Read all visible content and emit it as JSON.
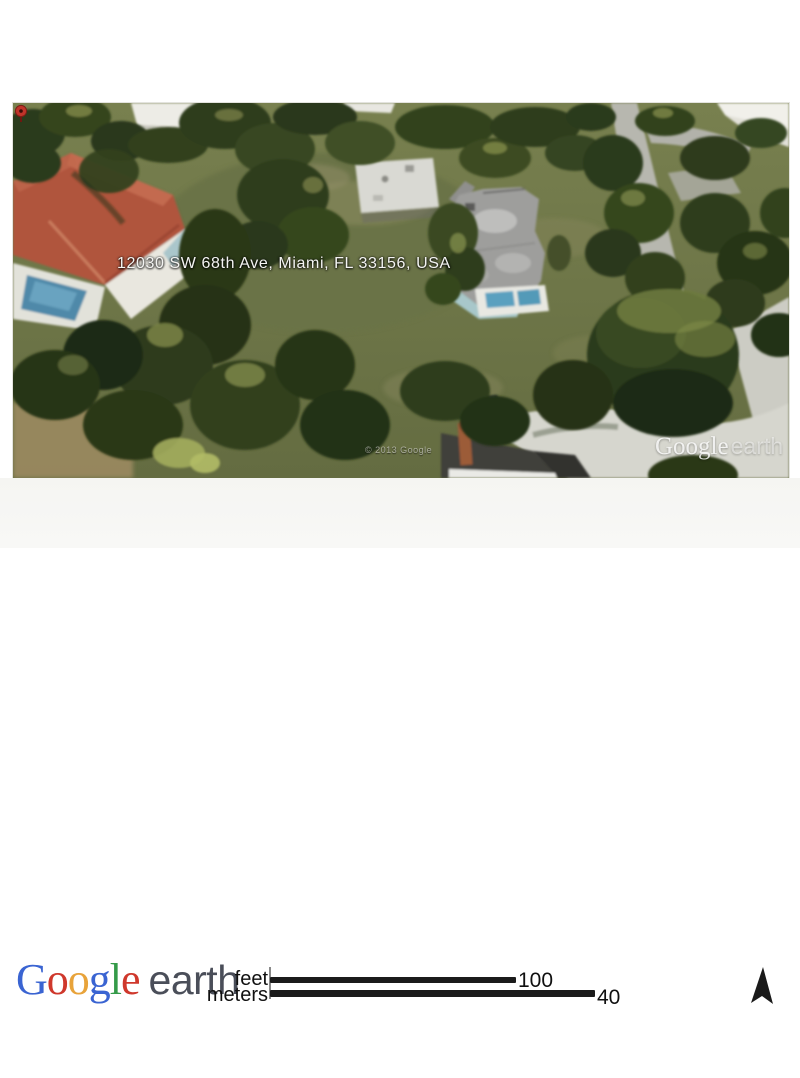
{
  "map": {
    "address": "12030 SW 68th Ave, Miami, FL 33156, USA",
    "copyright": "© 2013 Google",
    "watermark": {
      "google": "Google",
      "earth": "earth"
    }
  },
  "footer": {
    "logo": {
      "letters": [
        {
          "ch": "G",
          "color": "#3a64d2"
        },
        {
          "ch": "o",
          "color": "#cf382c"
        },
        {
          "ch": "o",
          "color": "#e8a33a"
        },
        {
          "ch": "g",
          "color": "#3a64d2"
        },
        {
          "ch": "l",
          "color": "#349a48"
        },
        {
          "ch": "e",
          "color": "#cf382c"
        }
      ],
      "earth": "earth",
      "earth_color": "#4a4e59"
    },
    "scale": {
      "feet": {
        "label": "feet",
        "value": "100"
      },
      "meters": {
        "label": "meters",
        "value": "40"
      }
    }
  },
  "colors": {
    "grass": "#6f774a",
    "trees_dark": "#2d3b1c",
    "road": "#b7b7af",
    "driveway": "#d6d6ce",
    "red_roof": "#b0543e",
    "gray_roof": "#9e9e9c",
    "pool_blue": "#4f89a9",
    "pin_red": "#c0342a",
    "scale_bar": "#1b1b1b",
    "compass": "#1a1a1a"
  }
}
